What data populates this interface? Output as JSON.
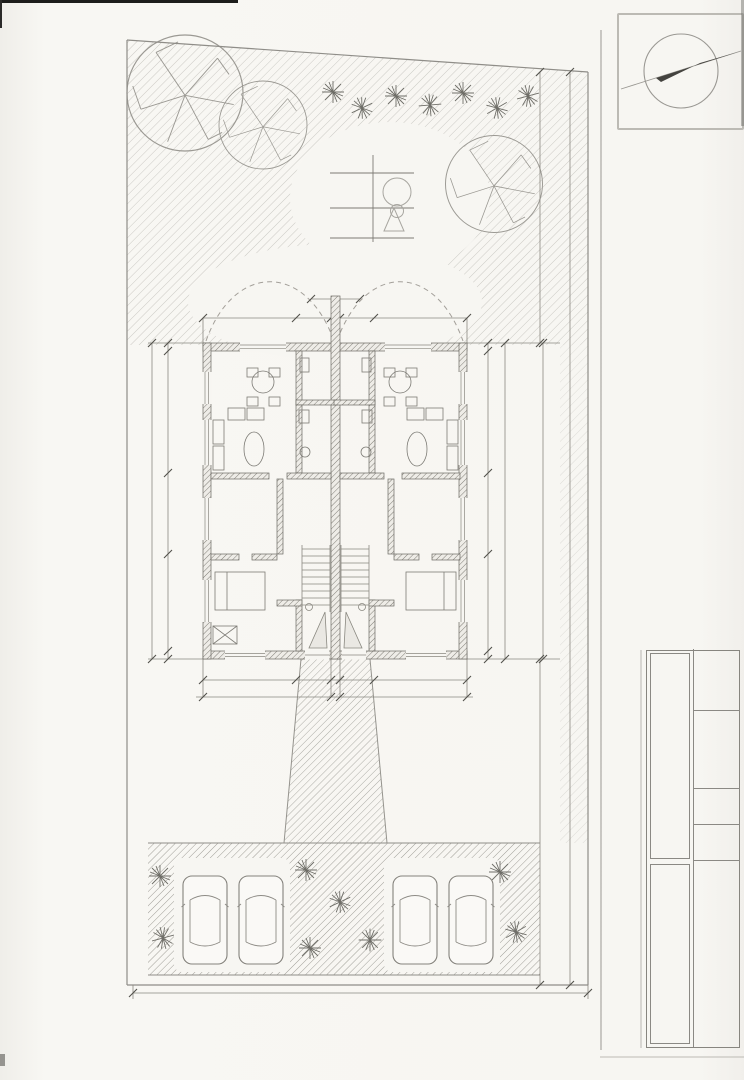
{
  "side_title": "Grundriss EG - Lageplan",
  "compass": {
    "letter": "N"
  },
  "legend": {
    "title": "RW",
    "row1": [
      "0,3",
      "0,6"
    ],
    "row2": [
      "II",
      "ED"
    ],
    "mark": "O"
  },
  "houses": {
    "h1": {
      "name": "Haus I",
      "area": "160,45qm"
    },
    "eg": "EG",
    "h2": {
      "name": "Haus II",
      "area": "160,41qm"
    }
  },
  "rooms": [
    {
      "label": "terrasse",
      "x": 257,
      "y": 336
    },
    {
      "label": "terrasse",
      "x": 396,
      "y": 336
    },
    {
      "label": "heiz",
      "a": "2,85qm",
      "x": 313,
      "y": 373,
      "s": 7
    },
    {
      "label": "heiz",
      "a": "2,85qm",
      "x": 352,
      "y": 373,
      "s": 7
    },
    {
      "label": "wohnen/kü",
      "a": "32,40qm",
      "x": 265,
      "y": 429
    },
    {
      "label": "wohnen/kü",
      "a": "32,40qm",
      "x": 404,
      "y": 429
    },
    {
      "label": "bad",
      "a": "4,88qm",
      "x": 322,
      "y": 437,
      "s": 8
    },
    {
      "label": "bad",
      "a": "4,88qm",
      "x": 361,
      "y": 437,
      "s": 8
    },
    {
      "label": "zimmer",
      "a": "16,00qm",
      "x": 233,
      "y": 507
    },
    {
      "label": "zimmer",
      "a": "16,00qm",
      "x": 424,
      "y": 507
    },
    {
      "label": "flur",
      "a": "11,34qm",
      "x": 314,
      "y": 491
    },
    {
      "label": "flur",
      "a": "11,34qm",
      "x": 357,
      "y": 491
    },
    {
      "label": "schlafen",
      "a": "18,10qm",
      "x": 243,
      "y": 609
    },
    {
      "label": "schlafen",
      "a": "18,10qm",
      "x": 425,
      "y": 607
    },
    {
      "label": "eingang1",
      "x": 313,
      "y": 652,
      "cls": "entry"
    },
    {
      "label": "eingang2",
      "x": 391,
      "y": 652,
      "cls": "entry"
    }
  ],
  "dims": [
    {
      "t": "199,0",
      "x": 336,
      "y": 289
    },
    {
      "t": "40,0",
      "x": 207,
      "y": 306
    },
    {
      "t": "562,5",
      "x": 252,
      "y": 306
    },
    {
      "t": "17,5",
      "x": 309,
      "y": 306
    },
    {
      "t": "164,0",
      "x": 333,
      "y": 298
    },
    {
      "t": "17,5",
      "x": 362,
      "y": 306
    },
    {
      "t": "561,5",
      "x": 418,
      "y": 306
    },
    {
      "t": "40,0",
      "x": 462,
      "y": 306
    },
    {
      "t": "45,0",
      "x": 163,
      "y": 352,
      "r": -90
    },
    {
      "t": "626,0",
      "x": 163,
      "y": 414,
      "r": -90
    },
    {
      "t": "11,5",
      "x": 163,
      "y": 478,
      "r": -90
    },
    {
      "t": "410,0",
      "x": 163,
      "y": 518,
      "r": -90
    },
    {
      "t": "11,5",
      "x": 163,
      "y": 560,
      "r": -90
    },
    {
      "t": "447,0",
      "x": 163,
      "y": 608,
      "r": -90
    },
    {
      "t": "40,0",
      "x": 163,
      "y": 652,
      "r": -90
    },
    {
      "t": "1586,0",
      "x": 148,
      "y": 505,
      "r": -90
    },
    {
      "t": "45,0",
      "x": 483,
      "y": 352,
      "r": -90
    },
    {
      "t": "626,0",
      "x": 483,
      "y": 414,
      "r": -90
    },
    {
      "t": "11,5",
      "x": 483,
      "y": 478,
      "r": -90
    },
    {
      "t": "410,0",
      "x": 483,
      "y": 518,
      "r": -90
    },
    {
      "t": "11,5",
      "x": 483,
      "y": 560,
      "r": -90
    },
    {
      "t": "447,0",
      "x": 483,
      "y": 608,
      "r": -90
    },
    {
      "t": "40,0",
      "x": 483,
      "y": 652,
      "r": -90
    },
    {
      "t": "1586,0",
      "x": 500,
      "y": 505,
      "r": -90
    },
    {
      "t": "1586,0",
      "x": 537,
      "y": 505,
      "r": -90,
      "f": 8
    },
    {
      "t": "4586,0",
      "x": 564,
      "y": 520,
      "r": -90,
      "f": 9
    },
    {
      "t": "1500,0",
      "x": 534,
      "y": 205,
      "r": -90,
      "f": 8
    },
    {
      "t": "1500,0",
      "x": 534,
      "y": 858,
      "r": -90,
      "f": 8
    },
    {
      "t": "40,0",
      "x": 207,
      "y": 675
    },
    {
      "t": "406,0",
      "x": 252,
      "y": 675
    },
    {
      "t": "17,5",
      "x": 297,
      "y": 675
    },
    {
      "t": "472,5",
      "x": 336,
      "y": 675
    },
    {
      "t": "17,5",
      "x": 374,
      "y": 675
    },
    {
      "t": "405,5",
      "x": 419,
      "y": 675
    },
    {
      "t": "40,0",
      "x": 462,
      "y": 675
    },
    {
      "t": "455,0",
      "x": 240,
      "y": 692
    },
    {
      "t": "427,0",
      "x": 336,
      "y": 692
    },
    {
      "t": "468,0",
      "x": 420,
      "y": 692
    },
    {
      "t": "2000,0",
      "x": 345,
      "y": 984,
      "f": 9.5
    }
  ],
  "titleblock": {
    "bauvorh_label": "Bauvorh.:",
    "bauvorh_lines": [
      "Neubau eines",
      "Doppelhauses",
      "Jahnstr. 14",
      "64665 Alsbach"
    ],
    "bauherr_label": "Bauherr:",
    "bauherr_lines": [
      "Klaus Lautenschläger",
      "Johann-Focke-Str. 6",
      "28203 Bremen"
    ],
    "zeichnung_label": "Zeichnung(en):",
    "zeichnung_lines": [
      "Grundriss EG",
      "Lageplan"
    ],
    "flur_label": "Flur:",
    "flurstueck_label": "Flurstück:",
    "flurstueck_value": "686",
    "datum_label": "Datum:",
    "datum_lines": [
      "03.11.",
      "2025"
    ],
    "projekt_label": "Projekt:",
    "projekt_value": "als/25"
  }
}
